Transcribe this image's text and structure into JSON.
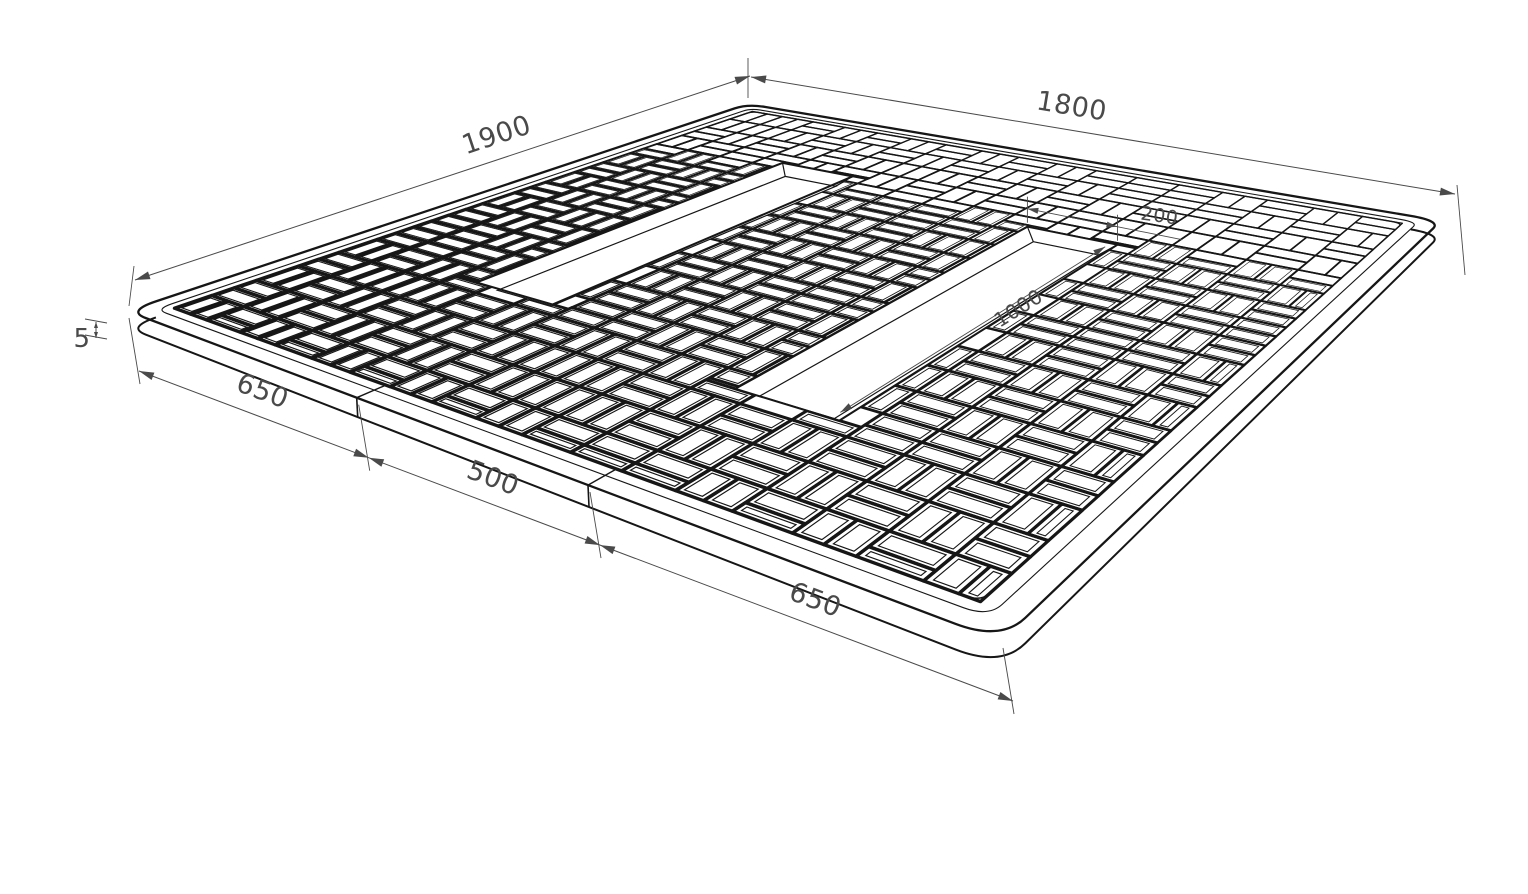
{
  "document": {
    "type": "isometric CAD technical drawing",
    "subject": "square paving mat with basketweave tile pattern, beveled border and two recessed rectangular slots",
    "units": "mm",
    "background": "#ffffff",
    "ink_color": "#161616",
    "dim_color": "#4a4a4a"
  },
  "mat": {
    "width_mm": 1800,
    "depth_mm": 1900,
    "thickness_label": "5",
    "corner_radius_mm": 60,
    "border_mm": 60,
    "tile_unit_mm": 100,
    "front_sections_mm": [
      650,
      500,
      650
    ],
    "slots": [
      {
        "name": "left-slot",
        "u0": 420,
        "u1": 620,
        "v0": 420,
        "v1": 1420,
        "length_mm": 1000,
        "width_mm": 200
      },
      {
        "name": "right-slot",
        "u0": 1120,
        "u1": 1320,
        "v0": 520,
        "v1": 1520,
        "length_mm": 1000,
        "width_mm": 200
      }
    ]
  },
  "dimensions": {
    "depth": {
      "label": "1900",
      "edge": "top-left"
    },
    "width": {
      "label": "1800",
      "edge": "top-right"
    },
    "front_left": {
      "label": "650",
      "edge": "front-left section 1"
    },
    "front_mid": {
      "label": "500",
      "edge": "front-left section 2"
    },
    "front_right": {
      "label": "650",
      "edge": "front-left section 3"
    },
    "thickness": {
      "label": "5",
      "edge": "left corner height"
    },
    "slot_length": {
      "label": "1000",
      "edge": "right slot long side"
    },
    "slot_width": {
      "label": "200",
      "edge": "right slot back end"
    }
  }
}
